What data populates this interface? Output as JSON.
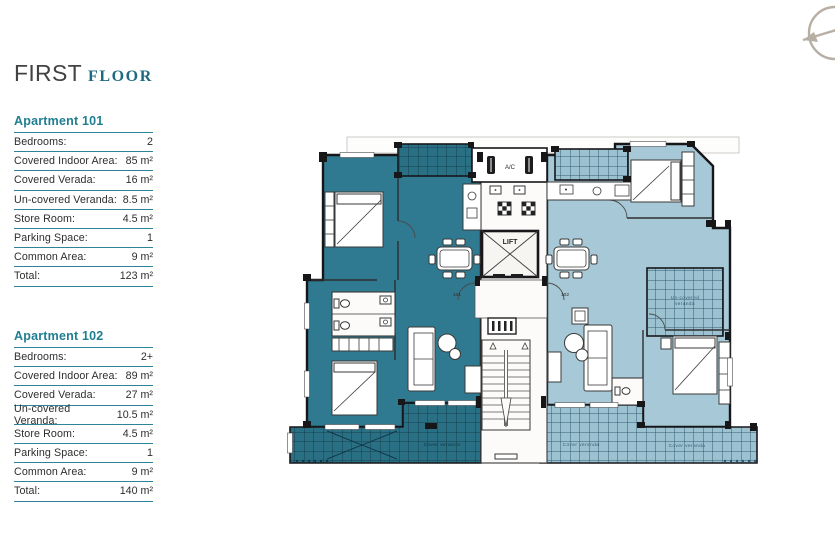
{
  "title": {
    "first": "FIRST",
    "floor": "FLOOR"
  },
  "apartments": [
    {
      "name": "Apartment 101",
      "rows": [
        {
          "label": "Bedrooms:",
          "value": "2"
        },
        {
          "label": "Covered Indoor Area:",
          "value": "85 m²"
        },
        {
          "label": "Covered Verada:",
          "value": "16 m²"
        },
        {
          "label": "Un-covered Veranda:",
          "value": "8.5 m²"
        },
        {
          "label": "Store Room:",
          "value": "4.5 m²"
        },
        {
          "label": "Parking Space:",
          "value": "1"
        },
        {
          "label": "Common Area:",
          "value": "9 m²"
        },
        {
          "label": "Total:",
          "value": "123 m²"
        }
      ]
    },
    {
      "name": "Apartment 102",
      "rows": [
        {
          "label": "Bedrooms:",
          "value": "2+"
        },
        {
          "label": "Covered Indoor Area:",
          "value": "89 m²"
        },
        {
          "label": "Covered Verada:",
          "value": "27 m²"
        },
        {
          "label": "Un-covered Veranda:",
          "value": "10.5 m²"
        },
        {
          "label": "Store Room:",
          "value": "4.5 m²"
        },
        {
          "label": "Parking Space:",
          "value": "1"
        },
        {
          "label": "Common Area:",
          "value": "9 m²"
        },
        {
          "label": "Total:",
          "value": "140 m²"
        }
      ]
    }
  ],
  "plan": {
    "labels": {
      "ac": "A/C",
      "lift": "LIFT",
      "door_101": "101",
      "door_102": "102",
      "veranda_bottom_left": "Cover veranda",
      "veranda_bottom_right_1": "Cover veranda",
      "veranda_bottom_right_2": "Cover veranda",
      "veranda_side_line1": "Un-covered",
      "veranda_side_line2": "veranda"
    }
  },
  "colors": {
    "apt101": "#2f7a91",
    "apt102": "#a7c8d6",
    "verandaDark": "#2a7085",
    "verandaLight": "#9cc2d2",
    "gridDark": "#16404f",
    "gridLight": "#2f5d73",
    "wall": "#17171a",
    "tealHead": "#1e7e92",
    "tealLine": "#2e8398",
    "titleInk": "#424242",
    "floorTeal": "#1e6a80"
  }
}
